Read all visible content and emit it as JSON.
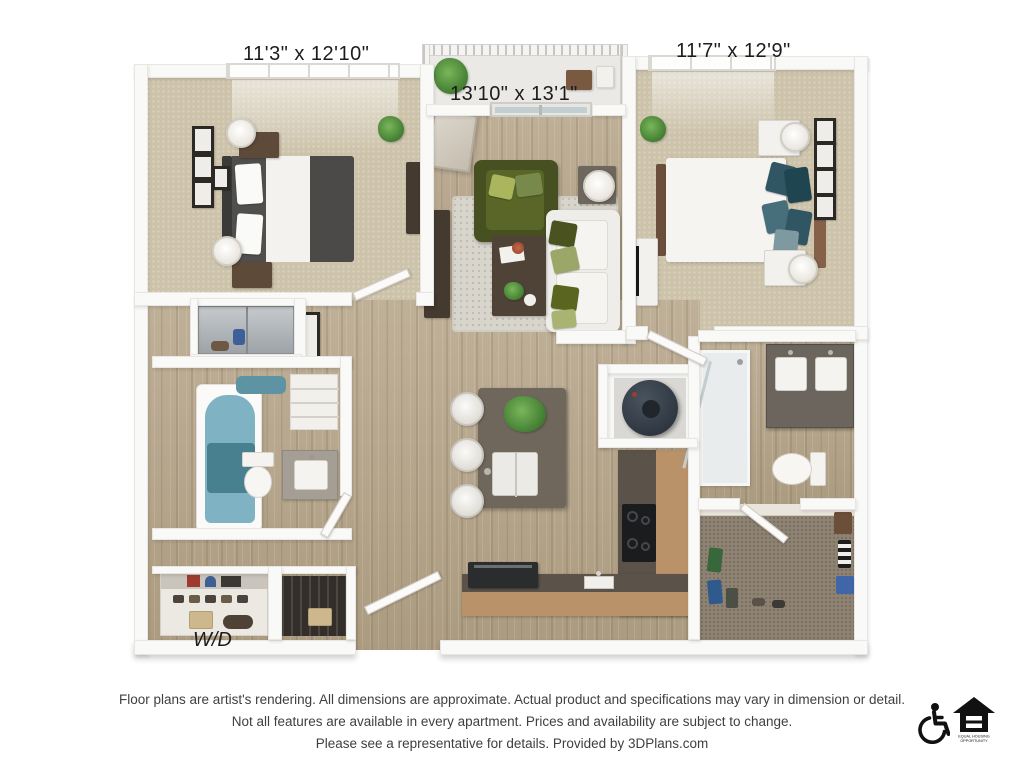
{
  "floor_plan": {
    "type": "2 bedroom / 2 bath apartment 3D floor plan",
    "labels": {
      "bedroom_left": "11'3\" x 12'10\"",
      "living_room": "13'10\" x 13'1\"",
      "bedroom_right": "11'7\" x 12'9\"",
      "washer_dryer": "W/D"
    },
    "rooms": [
      {
        "name": "bedroom-left",
        "dimensions": "11'3\" x 12'10\""
      },
      {
        "name": "living-room-balcony",
        "dimensions": "13'10\" x 13'1\""
      },
      {
        "name": "bedroom-right",
        "dimensions": "11'7\" x 12'9\""
      },
      {
        "name": "laundry-closet",
        "label": "W/D"
      }
    ]
  },
  "disclaimer": {
    "line1": "Floor plans are artist's rendering. All dimensions are approximate. Actual product and specifications may vary in dimension or detail.",
    "line2": "Not all features are available in every apartment. Prices and availability are subject to change.",
    "line3": "Please see a representative for details. Provided by 3DPlans.com"
  },
  "icons": {
    "accessibility": "wheelchair-accessible-icon",
    "equal_housing": "equal-housing-opportunity-icon",
    "equal_housing_line1": "EQUAL HOUSING",
    "equal_housing_line2": "OPPORTUNITY"
  },
  "colors": {
    "background": "#ffffff",
    "walls": "#f9f9f7",
    "wood_floor": "#b6a78e",
    "carpet": "#cdc3ab",
    "closet_carpet": "#8e8273",
    "dark_bed": "#4b4a48",
    "teal_pillows": "#2f5662",
    "olive_chair": "#56632a",
    "tub_water": "#7fb3c4",
    "cabinet_tan": "#b9926a",
    "countertop": "#5b5349",
    "text": "#3f3f3f"
  }
}
